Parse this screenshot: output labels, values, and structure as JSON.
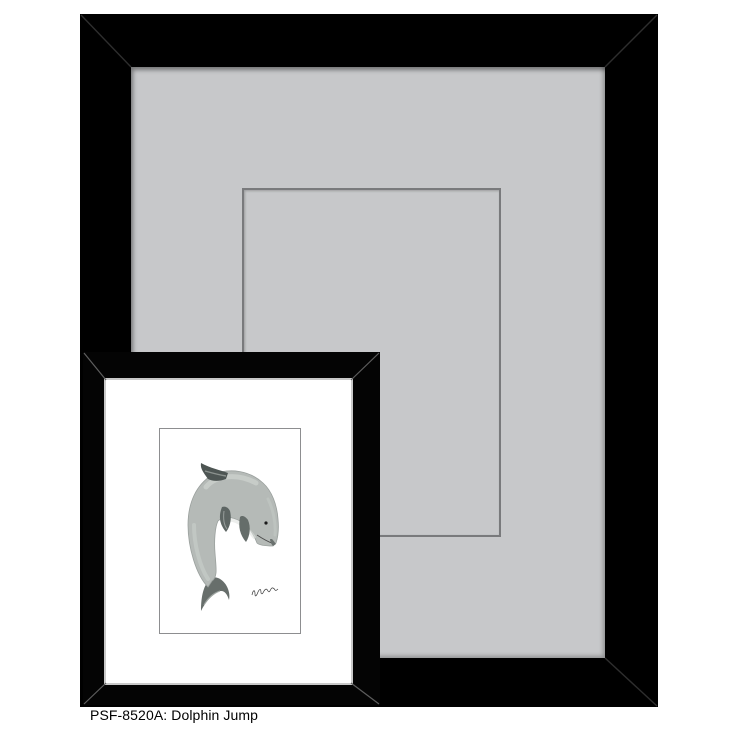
{
  "background_color": "#ffffff",
  "caption": {
    "text": "PSF-8520A: Dolphin Jump",
    "sku": "PSF-8520A",
    "title": "Dolphin Jump"
  },
  "large_frame_sample": {
    "frame_color": "#000000",
    "mat_color": "#c7c8ca",
    "opening_outline_color": "#797a7c"
  },
  "framed_print": {
    "frame_color": "#040404",
    "mat_color": "#ffffff",
    "art": {
      "subject": "dolphin-watercolor-illustration",
      "paper_color": "#ffffff",
      "body_color": "#b5bab7",
      "fin_color": "#5d6563"
    }
  }
}
